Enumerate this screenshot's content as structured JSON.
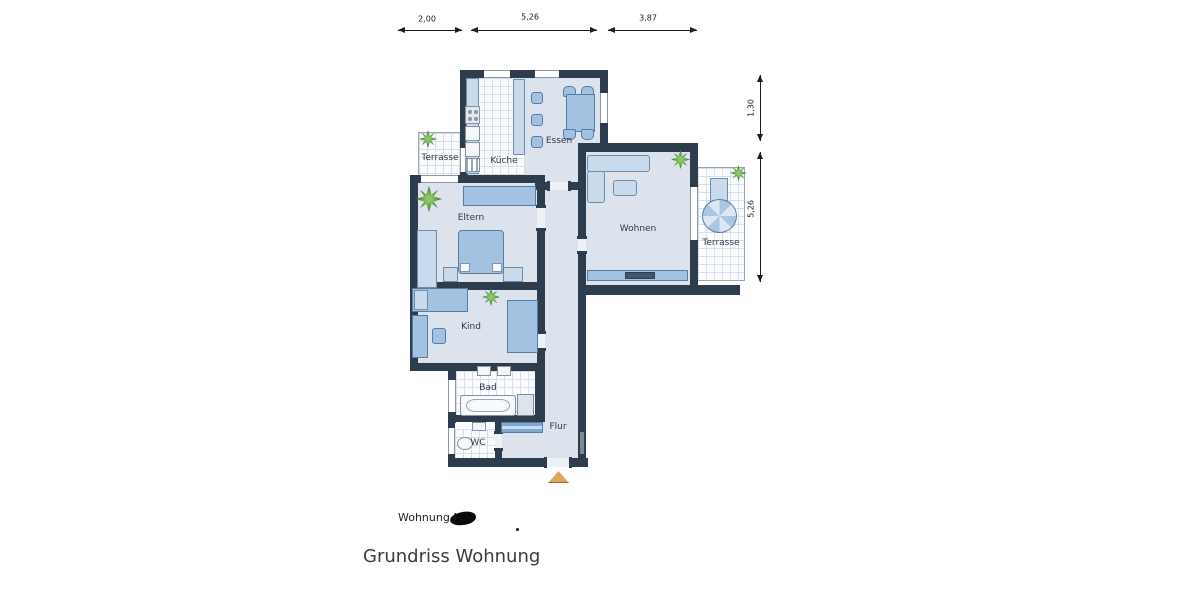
{
  "plan": {
    "rooms": {
      "terrasse_links": {
        "label": "Terrasse"
      },
      "kueche": {
        "label": "Küche"
      },
      "essen": {
        "label": "Essen"
      },
      "eltern": {
        "label": "Eltern"
      },
      "wohnen": {
        "label": "Wohnen"
      },
      "terrasse_rechts": {
        "label": "Terrasse"
      },
      "kind": {
        "label": "Kind"
      },
      "bad": {
        "label": "Bad"
      },
      "wc": {
        "label": "WC"
      },
      "flur": {
        "label": "Flur"
      }
    },
    "dimensions": {
      "top": {
        "d1": "2,00",
        "d2": "5,26",
        "d3": "3,87"
      },
      "right": {
        "d1": "1,30",
        "d2": "5,26"
      }
    },
    "colors": {
      "wall": "#2e3d4d",
      "floor": "#dce3ed",
      "furniture": "#a3c2e2",
      "furniture_light": "#c9daed",
      "plant_green": "#4c8a3c",
      "entrance_arrow": "#dda75f"
    }
  },
  "footer": {
    "apartment_label": "Wohnung Nr.",
    "title": "Grundriss Wohnung"
  }
}
